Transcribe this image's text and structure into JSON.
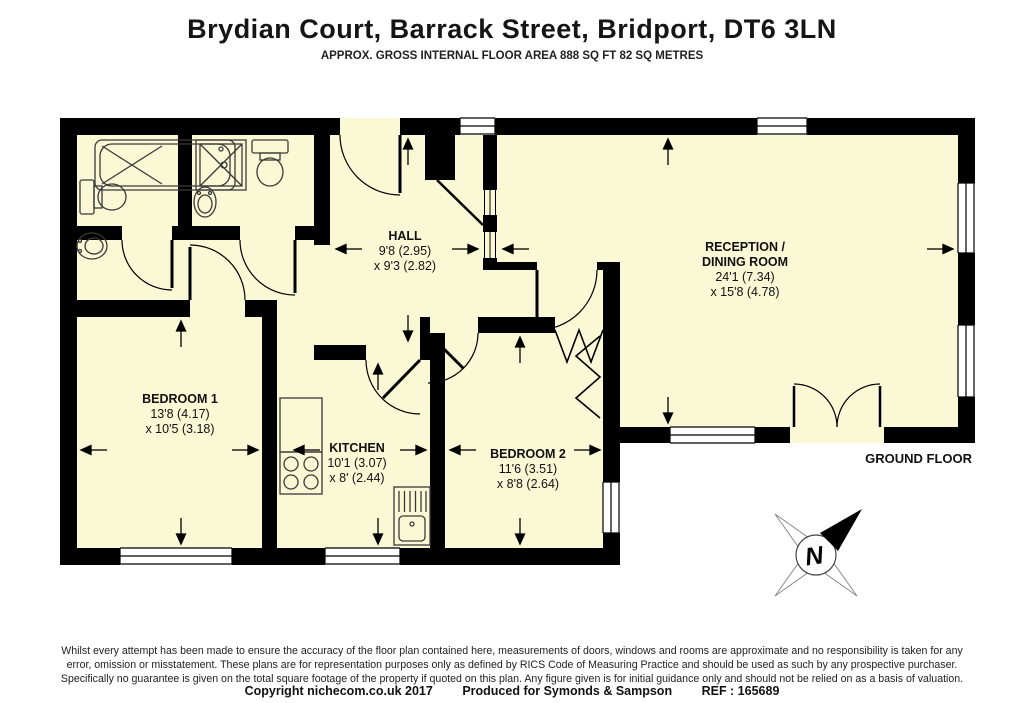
{
  "header": {
    "title": "Brydian Court, Barrack Street, Bridport, DT6 3LN",
    "subtitle": "APPROX. GROSS INTERNAL FLOOR AREA 888 SQ FT 82 SQ METRES"
  },
  "floorplan": {
    "floor_label": "GROUND FLOOR",
    "compass_letter": "N",
    "rooms": [
      {
        "name": "HALL",
        "name2": "",
        "dim1": "9'8 (2.95)",
        "dim2": "x 9'3 (2.82)"
      },
      {
        "name": "RECEPTION /",
        "name2": "DINING ROOM",
        "dim1": "24'1 (7.34)",
        "dim2": "x 15'8 (4.78)"
      },
      {
        "name": "BEDROOM 1",
        "name2": "",
        "dim1": "13'8 (4.17)",
        "dim2": "x 10'5 (3.18)"
      },
      {
        "name": "KITCHEN",
        "name2": "",
        "dim1": "10'1 (3.07)",
        "dim2": "x 8' (2.44)"
      },
      {
        "name": "BEDROOM 2",
        "name2": "",
        "dim1": "11'6 (3.51)",
        "dim2": "x 8'8 (2.64)"
      }
    ],
    "colors": {
      "floor": "#FBF8D5",
      "wall": "#000000",
      "fixture": "#3a3a3a"
    }
  },
  "footer": {
    "disclaimer_lines": [
      "Whilst every attempt has been made to ensure the accuracy of the floor plan contained here, measurements of doors, windows and rooms are approximate and no responsibility is taken for any",
      "error, omission or misstatement. These plans are for representation purposes only as defined by RICS Code of Measuring Practice and should be used as such by any prospective purchaser.",
      "Specifically no guarantee is given on the total square footage of the property if quoted on this plan. Any figure given is for initial guidance only and should not be relied on as a basis of valuation."
    ],
    "copyright": "Copyright nichecom.co.uk 2017",
    "produced": "Produced for Symonds & Sampson",
    "ref": "REF : 165689"
  }
}
